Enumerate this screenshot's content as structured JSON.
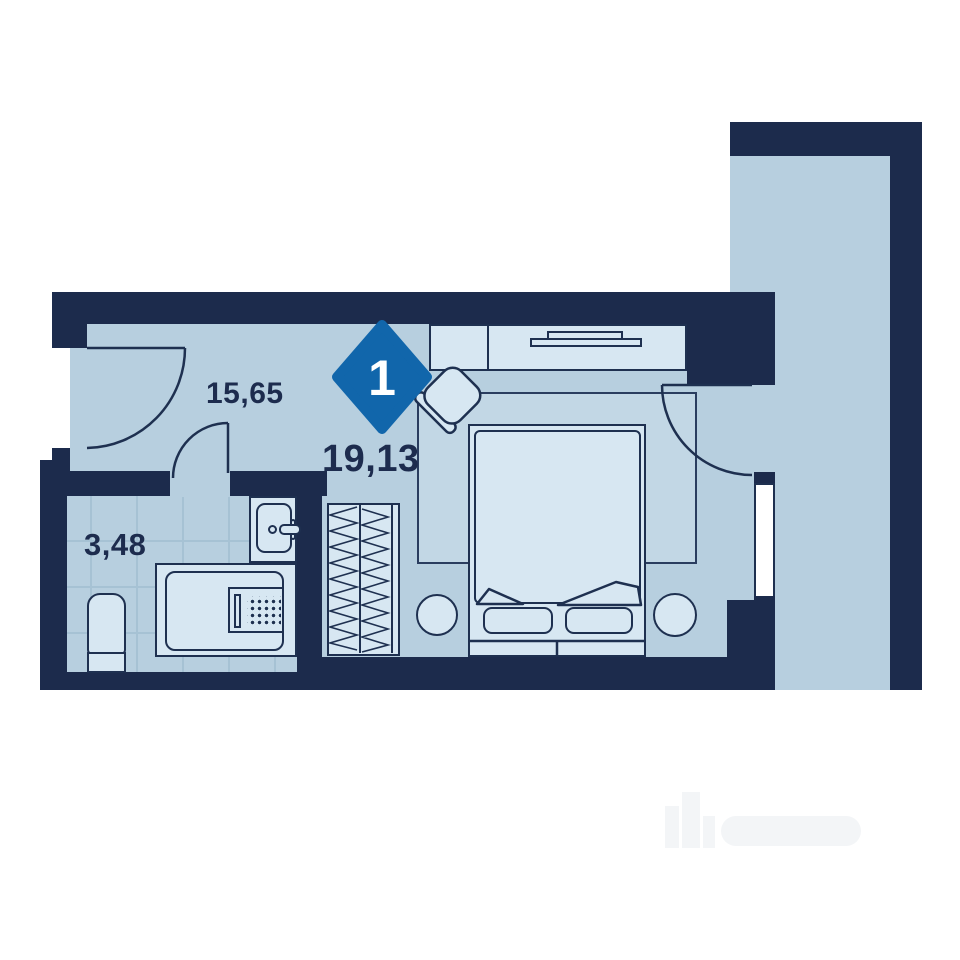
{
  "plan": {
    "kind": "apartment-floor-plan",
    "badge": {
      "rooms_count": "1",
      "color": "#1166ab"
    },
    "areas": {
      "hall": "15,65",
      "living": "19,13",
      "bathroom": "3,48"
    },
    "colors": {
      "wall": "#1c2b4c",
      "outline": "#1e3050",
      "floor": "#b7cfdf",
      "furniture": "#d7e7f2",
      "rug": "#c2d7e5",
      "tile_grid": "#a6c2d4",
      "window": "#ffffff",
      "badge_blue": "#1166ab",
      "label_text": "#1d2c4e"
    },
    "furniture": [
      "console-with-tv",
      "chair",
      "rug",
      "double-bed",
      "pillow",
      "blanket-fold",
      "bedside-table",
      "wardrobe",
      "toilet",
      "bathtub",
      "appliance-panel",
      "sink",
      "faucet",
      "window",
      "entrance-door",
      "bathroom-door",
      "balcony-door",
      "loggia"
    ]
  }
}
